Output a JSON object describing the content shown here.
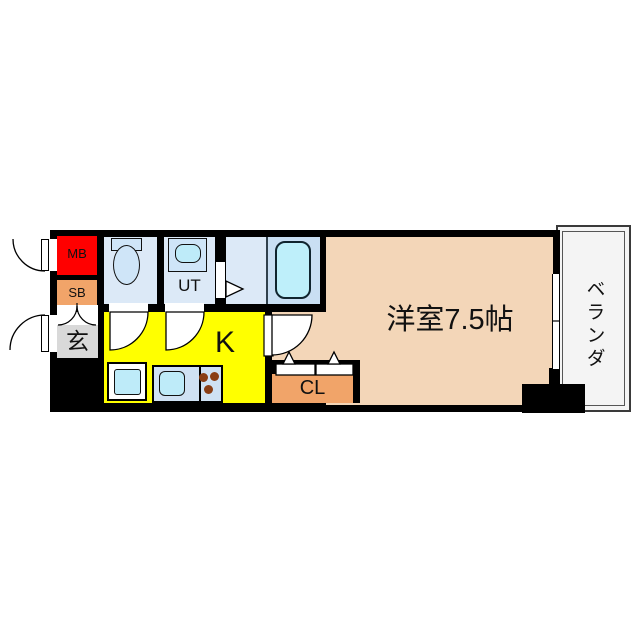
{
  "title": "1K apartment floor plan",
  "floorplan": {
    "rooms": {
      "mb": {
        "label": "MB"
      },
      "sb": {
        "label": "SB"
      },
      "genkan": {
        "label": "玄"
      },
      "ut": {
        "label": "UT"
      },
      "kitchen": {
        "label": "K"
      },
      "closet": {
        "label": "CL"
      },
      "main_room": {
        "label": "洋室7.5帖"
      },
      "veranda": {
        "label": "ベランダ"
      }
    },
    "colors": {
      "wall": "#000000",
      "mb_red": "#FF0000",
      "cabinet_orange": "#F1A469",
      "kitchen_yellow": "#FFFF00",
      "room_peach": "#F3D6B8",
      "genkan_gray": "#D9D9D9",
      "wet_room_blue": "#DCE9F7",
      "bath_panel_blue": "#C9DFF3",
      "tub_cyan": "#BEEFFA",
      "fixture_blue": "#CFE5F8",
      "basin_cyan": "#BEEBF9",
      "counter_blue": "#CFE1F3",
      "burner_brown": "#8A3E15",
      "veranda_white": "#F4F4F4"
    }
  }
}
